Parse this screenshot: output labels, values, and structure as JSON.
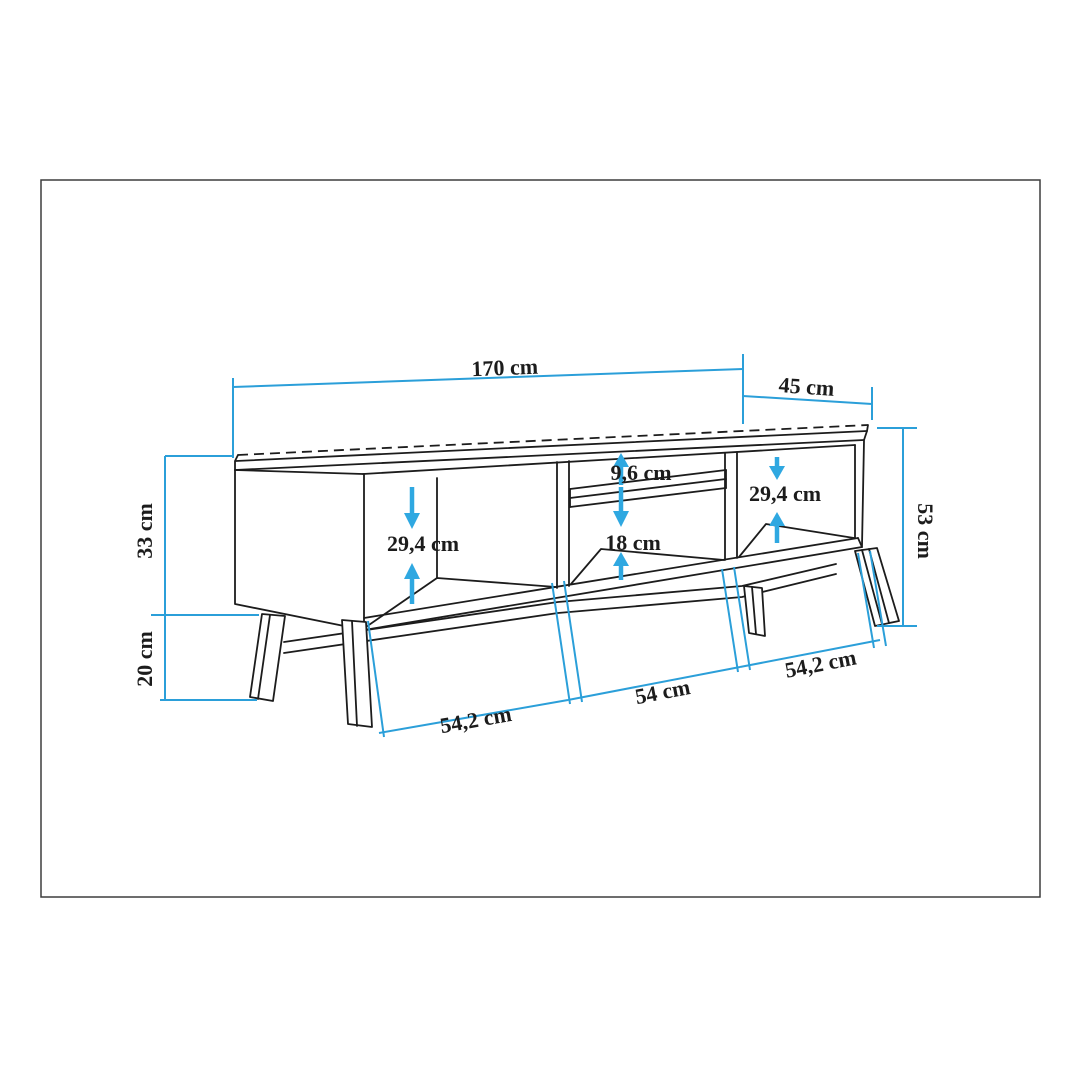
{
  "title": "TV stand dimension diagram",
  "labels": {
    "width_top": "170 cm",
    "depth": "45 cm",
    "carcass_height": "33 cm",
    "leg_height": "20 cm",
    "total_height": "53 cm",
    "left_opening_height": "29,4 cm",
    "shelf_gap": "9,6 cm",
    "lower_gap": "18 cm",
    "right_opening_height": "29,4 cm",
    "bottom_left_width": "54,2 cm",
    "bottom_middle_width": "54 cm",
    "bottom_right_width": "54,2 cm"
  },
  "colors": {
    "ink": "#1c1c1c",
    "dim-line": "#2b9fd9",
    "arrow": "#2fa8e1",
    "frame": "#3d3d3d",
    "background": "#ffffff"
  }
}
